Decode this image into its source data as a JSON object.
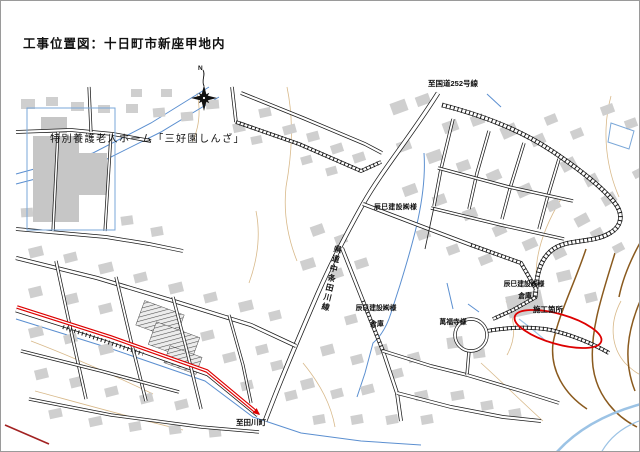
{
  "page": {
    "title": "工事位置図：十日町市新座甲地内"
  },
  "labels": {
    "north": "N",
    "route252": "至国道252号線",
    "nursing_home": "特別養護老人ホーム「三好園しんざ」",
    "tatsumi": "辰巳建設㈱様",
    "tatsumi_warehouse1": {
      "line1": "辰巳建設㈱様",
      "line2": "倉庫"
    },
    "tatsumi_warehouse2": {
      "line1": "辰巳建設㈱様",
      "line2": "倉庫"
    },
    "manpukuji": "萬福寺様",
    "construction_site": "施工箇所",
    "pref_road": "県道中条田川線",
    "to_tagawa": "至田川町"
  },
  "colors": {
    "building": "#cfcfcf",
    "building_dark": "#c6c6c6",
    "road": "#1a1a1a",
    "water": "#5b8fd0",
    "water_light": "#9cc3e5",
    "contour": "#d8b98a",
    "contour_dark": "#8a5a1e",
    "highlight_red": "#dd0000",
    "route_dark_red": "#a22222",
    "label_green": "#2da05a",
    "label_blue": "#2e6fbe"
  }
}
